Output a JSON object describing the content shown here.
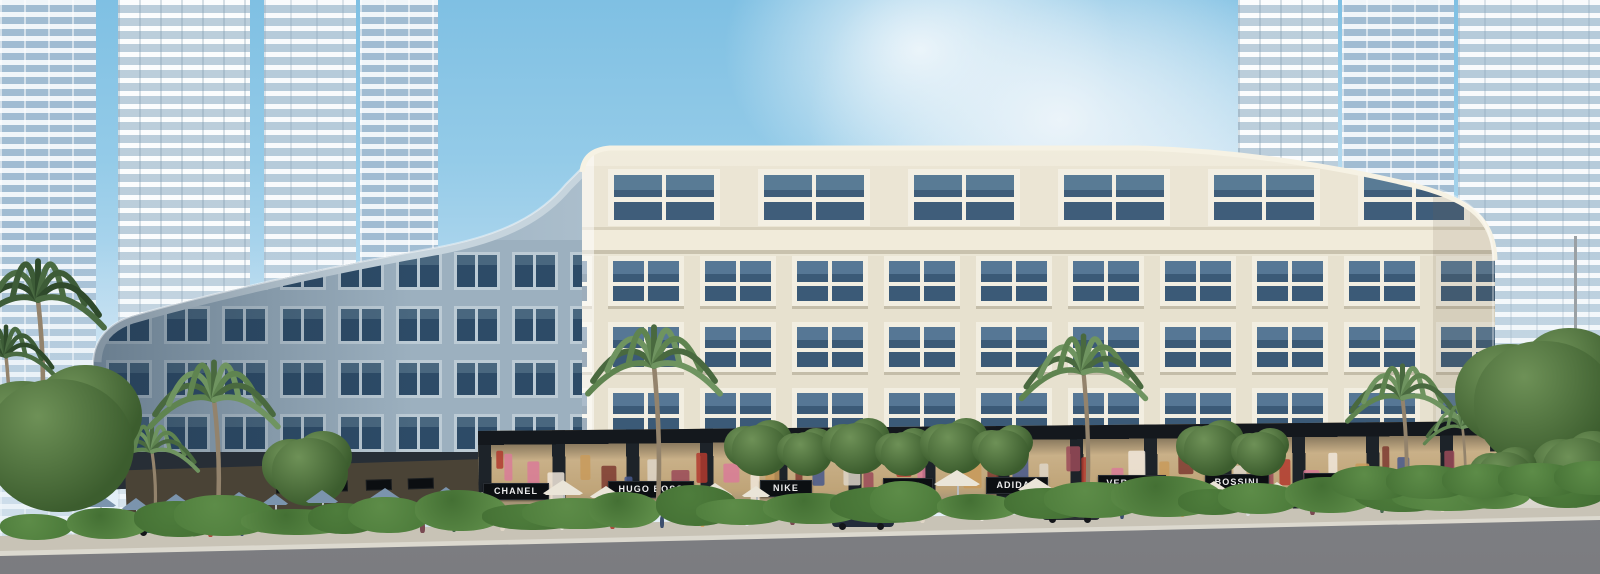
{
  "meta": {
    "title": "Shophouse boulevard — architectural rendering",
    "description": "Curved cream mixed-use podium building with luxury retail storefronts at street level, palm-lined promenade, hedges and road in front, high-rise residential towers behind under a blue sky"
  },
  "storefront": {
    "signs": [
      {
        "label": "CHANEL"
      },
      {
        "label": "HUGO BOSS"
      },
      {
        "label": "NIKE"
      },
      {
        "label": "DIOR"
      },
      {
        "label": "ADIDAS"
      },
      {
        "label": "VERSACE"
      },
      {
        "label": "BOSSINI"
      },
      {
        "label": "CHANEL"
      },
      {
        "label": "HUGO BOSS"
      }
    ]
  },
  "palette": {
    "sky_blue": "#7fc0e3",
    "cloud_white": "#eef5fa",
    "tower_glass": "#b6cfe2",
    "facade_cream": "#e8e2d0",
    "facade_shadow_wing": "#9cb0bf",
    "window_glass": "#3b5a77",
    "retail_fascia": "#14181d",
    "sign_background": "#0c0f12",
    "sign_text": "#ececec",
    "hedge_green": "#4e7d3c",
    "palm_green": "#5f8450",
    "sidewalk": "#c8c3b6",
    "road_grey": "#85868a"
  }
}
